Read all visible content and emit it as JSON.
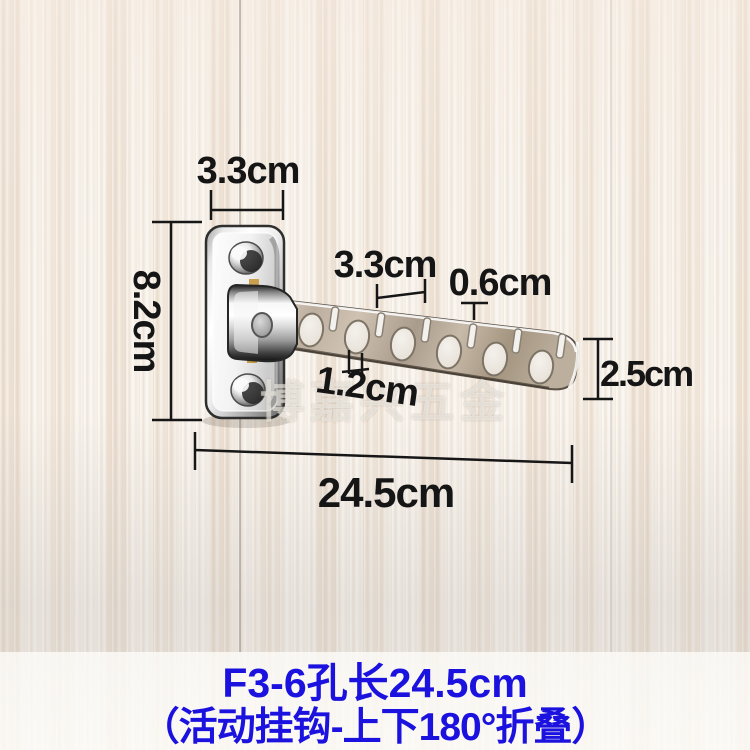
{
  "watermark": "博嘉兴五金",
  "caption": {
    "line1": "F3-6孔长24.5cm",
    "line2": "（活动挂钩-上下180°折叠）",
    "color": "#1b12df"
  },
  "dimensions": {
    "plate_width": "3.3cm",
    "plate_height": "8.2cm",
    "hole_spacing": "3.3cm",
    "slot_width": "0.6cm",
    "hole_width": "1.2cm",
    "arm_end_height": "2.5cm",
    "total_length": "24.5cm"
  },
  "colors": {
    "annotation_black": "#151515",
    "caption_blue": "#1b12df",
    "wood_base": "#f1ebe3"
  }
}
